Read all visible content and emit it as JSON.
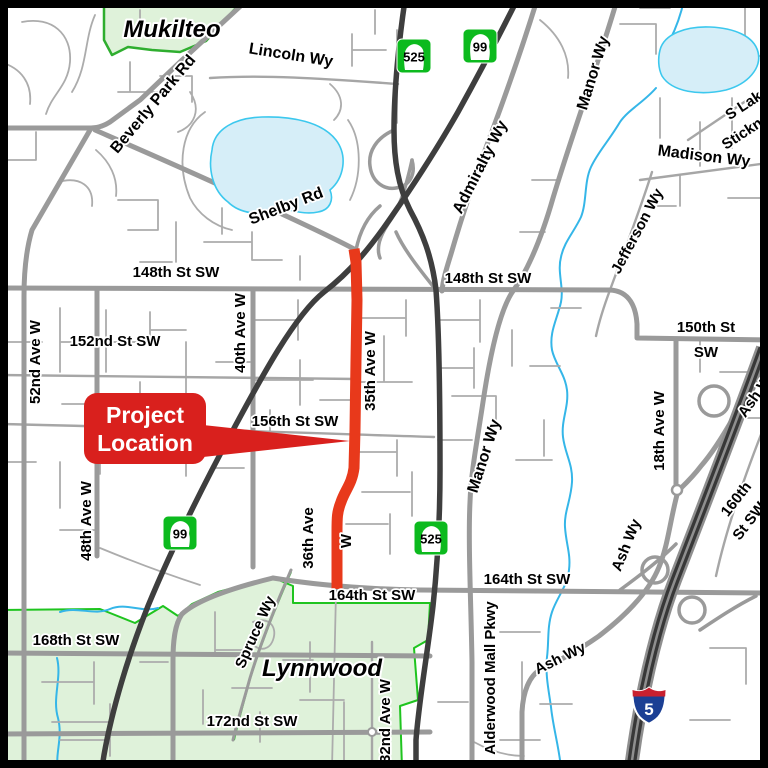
{
  "map": {
    "cities": {
      "mukilteo": "Mukilteo",
      "lynnwood": "Lynnwood"
    },
    "callout": {
      "line1": "Project",
      "line2": "Location"
    },
    "shields": {
      "sr525": "525",
      "sr99": "99",
      "i5": "5"
    },
    "streets": {
      "lincoln": "Lincoln Wy",
      "beverly_park": "Beverly Park Rd",
      "shelby": "Shelby Rd",
      "admiralty": "Admiralty Wy",
      "manor_north": "Manor Wy",
      "manor_south": "Manor Wy",
      "s_lake": "S Lake",
      "stickney": "Stickney",
      "madison": "Madison Wy",
      "jefferson": "Jefferson Wy",
      "st148_west": "148th St SW",
      "st148_east": "148th St SW",
      "st150_line1": "150th St",
      "st150_line2": "SW",
      "ave52": "52nd Ave W",
      "st152": "152nd St SW",
      "ave40": "40th Ave W",
      "ave35": "35th Ave W",
      "st156": "156th St SW",
      "ave48": "48th Ave W",
      "ave36": "36th Ave",
      "ave36_suffix": "W",
      "ave18": "18th Ave W",
      "ash_northeast": "Ash Wy",
      "ash_middle": "Ash Wy",
      "ash_south": "Ash Wy",
      "st160_line1": "160th",
      "st160_line2": "St SW",
      "st164_west": "164th St SW",
      "st164_east": "164th St SW",
      "st168": "168th St SW",
      "spruce": "Spruce Wy",
      "st172": "172nd St SW",
      "ave32": "32nd Ave W",
      "alderwood": "Alderwood Mall Pkwy"
    },
    "colors": {
      "project_red": "#E8391B",
      "callout_red": "#D9201D",
      "city_fill": "#DFF2DA",
      "mukilteo_border": "#2FAE2F",
      "lynnwood_border": "#1FC41F",
      "water_fill": "#D6EEF8",
      "water_line": "#35B6E8",
      "freeway_dark": "#3E3E3E",
      "major_road": "#9A9A9A",
      "minor_road": "#ACACAC",
      "state_shield_green": "#0CBA1E",
      "interstate_blue": "#1B3F94",
      "interstate_red": "#C8202F"
    }
  }
}
